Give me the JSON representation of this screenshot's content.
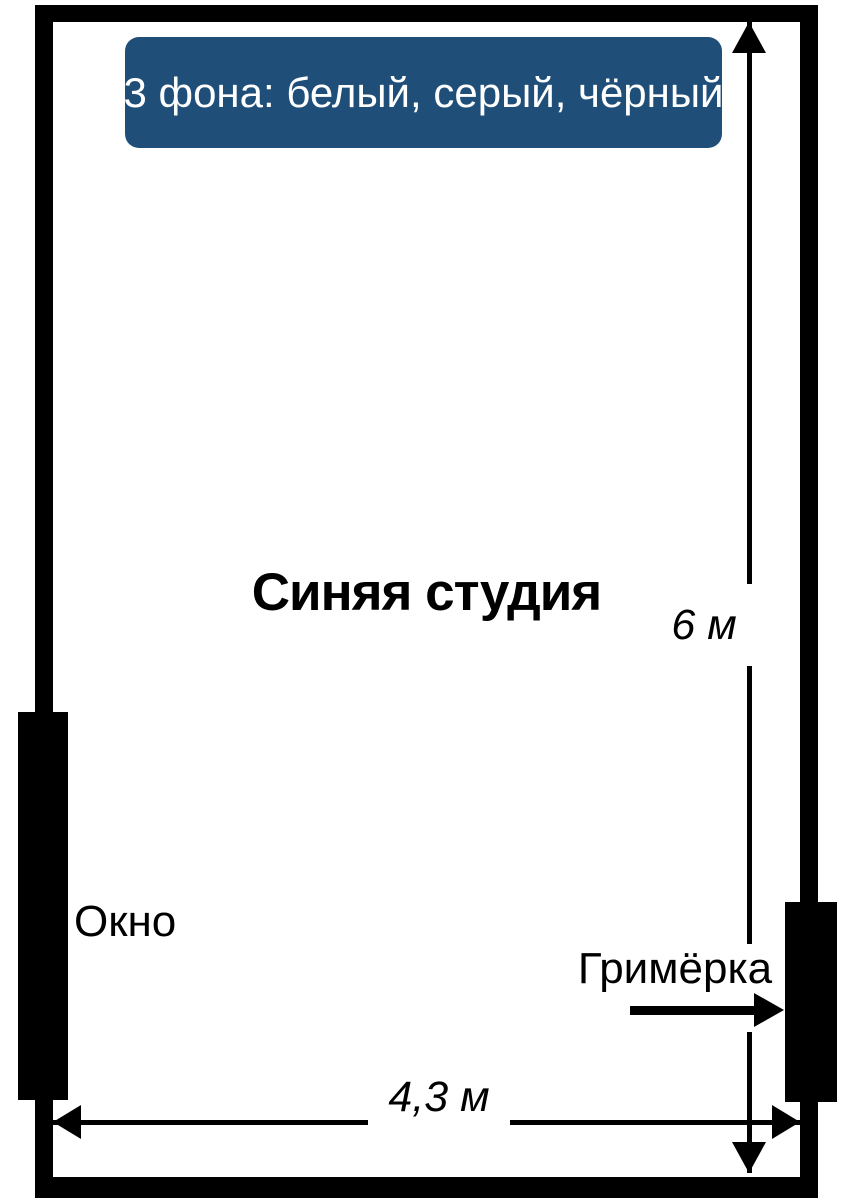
{
  "diagram": {
    "banner_text": "3 фона: белый, серый, чёрный",
    "title": "Синяя студия",
    "window_label": "Окно",
    "dressing_room_label": "Гримёрка",
    "height_dimension": "6 м",
    "width_dimension": "4,3 м"
  },
  "icons": {
    "up_arrowhead": "up-arrowhead",
    "down_arrowhead": "down-arrowhead",
    "left_arrowhead": "left-arrowhead",
    "right_arrowhead": "right-arrowhead"
  },
  "colors": {
    "banner_background": "#1F4E79",
    "banner_text": "#FFFFFF",
    "walls_and_arrows": "#000000",
    "page_background": "#FFFFFF"
  }
}
